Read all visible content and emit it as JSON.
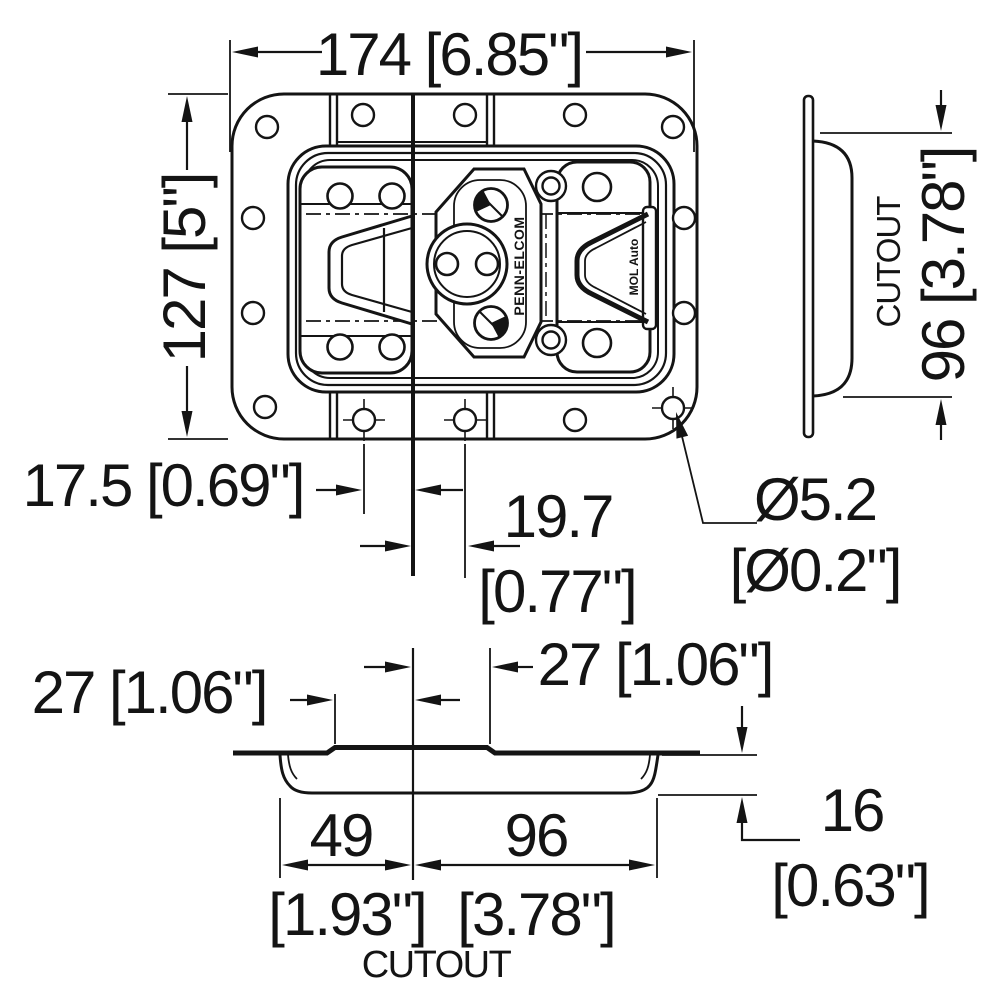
{
  "drawing": {
    "title": "recessed butterfly latch dimension drawing",
    "colors": {
      "ink": "#141414",
      "paper": "#ffffff"
    },
    "front": {
      "width_dim": "174 [6.85\"]",
      "height_dim": "127 [5\"]",
      "rivet_offset_left_dim": "17.5 [0.69\"]",
      "rivet_offset_right_mm": "19.7",
      "rivet_offset_right_in": "[0.77\"]",
      "hole_dia_mm": "Ø5.2",
      "hole_dia_in": "[Ø0.2\"]",
      "latch_brand_text": "PENN-ELCOM",
      "latch_model_text": "MOL Auto"
    },
    "side": {
      "cutout_label": "CUTOUT",
      "cutout_height_dim": "96 [3.78\"]"
    },
    "section": {
      "lip_left_dim": "27 [1.06\"]",
      "lip_right_dim": "27 [1.06\"]",
      "cutout_left_mm": "49",
      "cutout_left_in": "[1.93\"]",
      "cutout_right_mm": "96",
      "cutout_right_in": "[3.78\"]",
      "depth_mm": "16",
      "depth_in": "[0.63\"]",
      "cutout_label": "CUTOUT"
    }
  }
}
